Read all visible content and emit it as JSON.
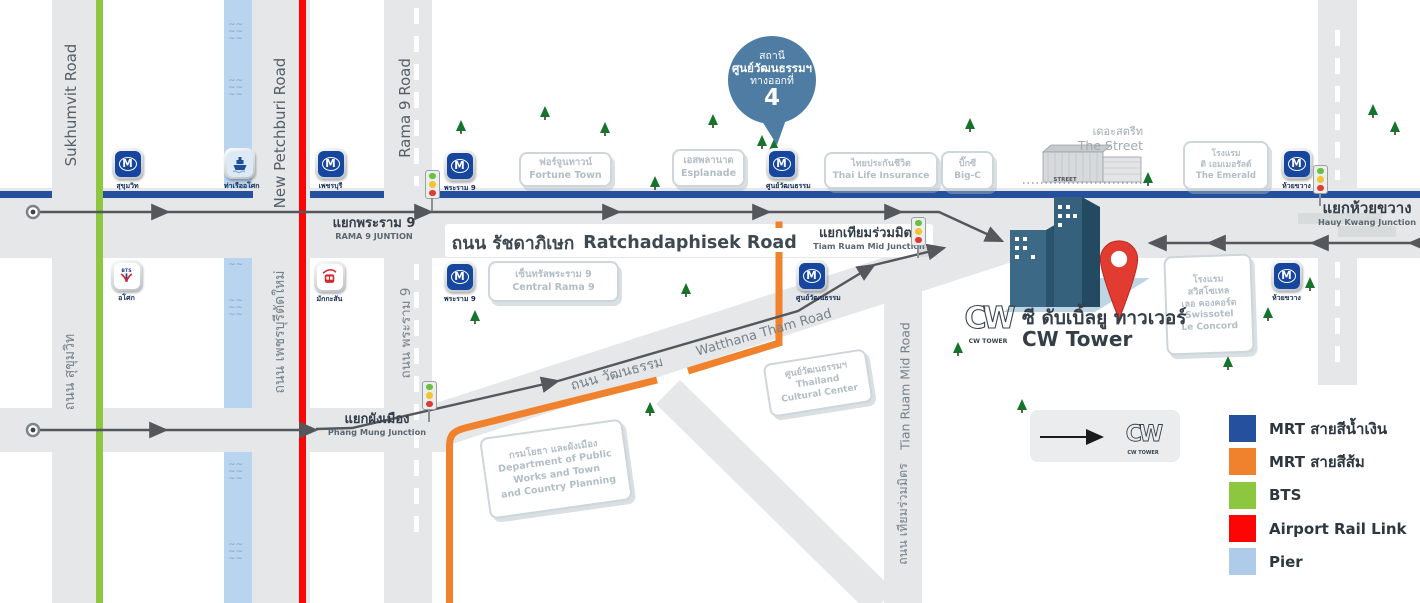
{
  "colors": {
    "mrt_blue": "#24509d",
    "mrt_orange": "#f0822d",
    "bts_green": "#8dc63f",
    "airport_red": "#fb0505",
    "pier_blue": "#aecbe9",
    "canal": "#b9d4ee",
    "road_gray": "#e5e7e9",
    "route_gray": "#54585c",
    "callout_blue": "#4e7ca3"
  },
  "legend": {
    "items": [
      {
        "color": "#24509d",
        "label": "MRT สายสีน้ำเงิน"
      },
      {
        "color": "#f0822d",
        "label": "MRT สายสีส้ม"
      },
      {
        "color": "#8dc63f",
        "label": "BTS"
      },
      {
        "color": "#fb0505",
        "label": "Airport Rail Link"
      },
      {
        "color": "#aecbe9",
        "label": "Pier"
      }
    ],
    "cw_caption": "CW TOWER"
  },
  "callout": {
    "line1": "สถานี",
    "line2": "ศูนย์วัฒนธรรมฯ",
    "line3": "ทางออกที่",
    "number": "4"
  },
  "cw_tower": {
    "thai": "ซี ดับเบิ้ลยู ทาวเวอร์",
    "eng": "CW Tower",
    "logo_caption": "CW TOWER"
  },
  "street": {
    "thai": "เดอะสตรีท",
    "eng": "The Street",
    "sign": "STREET"
  },
  "stations": [
    {
      "type": "mrt",
      "label": "สุขุมวิท",
      "x": 112,
      "y": 148
    },
    {
      "type": "pier",
      "label": "ท่าเรืออโศก",
      "x": 224,
      "y": 148
    },
    {
      "type": "mrt",
      "label": "เพชรบุรี",
      "x": 315,
      "y": 148
    },
    {
      "type": "mrt",
      "label": "พระราม 9",
      "x": 444,
      "y": 150
    },
    {
      "type": "mrt",
      "label": "ศูนย์วัฒนธรรม",
      "x": 766,
      "y": 148
    },
    {
      "type": "mrt",
      "label": "ห้วยขวาง",
      "x": 1281,
      "y": 148
    },
    {
      "type": "bts",
      "label": "อโศก",
      "x": 111,
      "y": 260
    },
    {
      "type": "arl",
      "label": "มักกะสัน",
      "x": 314,
      "y": 261
    },
    {
      "type": "mrt",
      "label": "พระราม 9",
      "x": 444,
      "y": 261
    },
    {
      "type": "mrt",
      "label": "ศูนย์วัฒนธรรม",
      "x": 796,
      "y": 260
    },
    {
      "type": "mrt",
      "label": "ห้วยขวาง",
      "x": 1271,
      "y": 260
    }
  ],
  "landmarks": [
    {
      "x": 519,
      "y": 152,
      "w": 89,
      "h": 31,
      "rot": 0,
      "fs": 9.5,
      "lines": [
        "ฟอร์จูนทาวน์",
        "Fortune Town"
      ]
    },
    {
      "x": 672,
      "y": 149,
      "w": 69,
      "h": 34,
      "rot": 0,
      "fs": 9.5,
      "lines": [
        "เอสพลานาด",
        "Esplanade"
      ]
    },
    {
      "x": 824,
      "y": 152,
      "w": 110,
      "h": 33,
      "rot": 0,
      "fs": 9,
      "lines": [
        "ไทยประกันชีวิต",
        "Thai Life Insurance"
      ]
    },
    {
      "x": 941,
      "y": 151,
      "w": 49,
      "h": 35,
      "rot": 0,
      "fs": 9,
      "lines": [
        "บิ๊กซี",
        "Big-C"
      ]
    },
    {
      "x": 1183,
      "y": 141,
      "w": 82,
      "h": 45,
      "rot": 0,
      "fs": 8.5,
      "lines": [
        "โรงแรม",
        "ดิ เอมเมอรัลด์",
        "The Emerald"
      ]
    },
    {
      "x": 488,
      "y": 261,
      "w": 127,
      "h": 37,
      "rot": 0,
      "fs": 9.5,
      "lines": [
        "เซ็นทรัลพระราม 9",
        "Central Rama 9"
      ]
    },
    {
      "x": 1165,
      "y": 255,
      "w": 84,
      "h": 95,
      "rot": -2,
      "fs": 9,
      "lines": [
        "โรงแรม",
        "สวิสโซเทล",
        "เลอ คองคอร์ด",
        "Swissotel",
        "Le Concord"
      ]
    },
    {
      "x": 766,
      "y": 356,
      "w": 100,
      "h": 50,
      "rot": -9,
      "fs": 9,
      "lines": [
        "ศูนย์วัฒนธรรมฯ",
        "Thailand",
        "Cultural Center"
      ]
    },
    {
      "x": 484,
      "y": 428,
      "w": 140,
      "h": 78,
      "rot": -8,
      "fs": 9.5,
      "lines": [
        "กรมโยธา และผังเมือง",
        "Department of Public",
        "Works and Town",
        "and Country Planning"
      ]
    }
  ],
  "junctions": [
    {
      "thai": "แยกพระราม 9",
      "eng": "RAMA 9 JUNTION",
      "x": 374,
      "y": 217,
      "big": false
    },
    {
      "thai": "แยกเทียมร่วมมิตร",
      "eng": "Tiam Ruam Mid Junction",
      "x": 869,
      "y": 227,
      "big": false
    },
    {
      "thai": "แยกห้วยขวาง",
      "eng": "Hauy Kwang Junction",
      "x": 1367,
      "y": 200,
      "big": true
    },
    {
      "thai": "แยกผังเมือง",
      "eng": "Phang Mung Junction",
      "x": 377,
      "y": 413,
      "big": false
    }
  ],
  "road_labels": [
    {
      "text": "ถนน รัชดาภิเษก",
      "cx": 513,
      "cy": 243,
      "size": 17.5,
      "rot": 0,
      "shade": "dark"
    },
    {
      "text": "Ratchadaphisek Road",
      "cx": 690,
      "cy": 243,
      "size": 17.5,
      "rot": 0,
      "shade": "dark"
    },
    {
      "text": "ถนน วัฒนธรรม",
      "cx": 617,
      "cy": 374,
      "size": 14,
      "rot": -15,
      "shade": "mid"
    },
    {
      "text": "Watthana Tham Road",
      "cx": 764,
      "cy": 333,
      "size": 13,
      "rot": -16,
      "shade": "mid"
    },
    {
      "text": "Sukhumvit Road",
      "cx": 71,
      "cy": 105,
      "size": 15,
      "rot": -90,
      "shade": "dark2"
    },
    {
      "text": "ถนน สุขุมวิท",
      "cx": 70,
      "cy": 372,
      "size": 14,
      "rot": -90,
      "shade": "mid"
    },
    {
      "text": "New Petchburi Road",
      "cx": 280,
      "cy": 133,
      "size": 15,
      "rot": -90,
      "shade": "dark2"
    },
    {
      "text": "ถนน เพชรบุรีตัดใหม่",
      "cx": 280,
      "cy": 332,
      "size": 14,
      "rot": -90,
      "shade": "mid"
    },
    {
      "text": "Rama 9 Road",
      "cx": 405,
      "cy": 108,
      "size": 15,
      "rot": -90,
      "shade": "dark2"
    },
    {
      "text": "ถนน พระราม 9",
      "cx": 405,
      "cy": 333,
      "size": 13.5,
      "rot": -90,
      "shade": "mid"
    },
    {
      "text": "Tian Ruam Mid Road",
      "cx": 905,
      "cy": 386,
      "size": 12.5,
      "rot": -90,
      "shade": "mid"
    },
    {
      "text": "ถนน เทียมร่วมมิตร",
      "cx": 903,
      "cy": 514,
      "size": 12.5,
      "rot": -90,
      "shade": "mid"
    }
  ],
  "trees": [
    [
      456,
      120
    ],
    [
      540,
      106
    ],
    [
      600,
      122
    ],
    [
      650,
      176
    ],
    [
      708,
      114
    ],
    [
      757,
      135
    ],
    [
      769,
      139
    ],
    [
      965,
      118
    ],
    [
      1143,
      172
    ],
    [
      1368,
      104
    ],
    [
      1390,
      121
    ],
    [
      470,
      310
    ],
    [
      681,
      283
    ],
    [
      645,
      402
    ],
    [
      798,
      384
    ],
    [
      953,
      342
    ],
    [
      1017,
      399
    ],
    [
      1263,
      307
    ],
    [
      1305,
      277
    ],
    [
      1223,
      356
    ]
  ],
  "traffic_lights": [
    [
      425,
      170
    ],
    [
      911,
      217
    ],
    [
      1313,
      165
    ],
    [
      422,
      381
    ]
  ]
}
